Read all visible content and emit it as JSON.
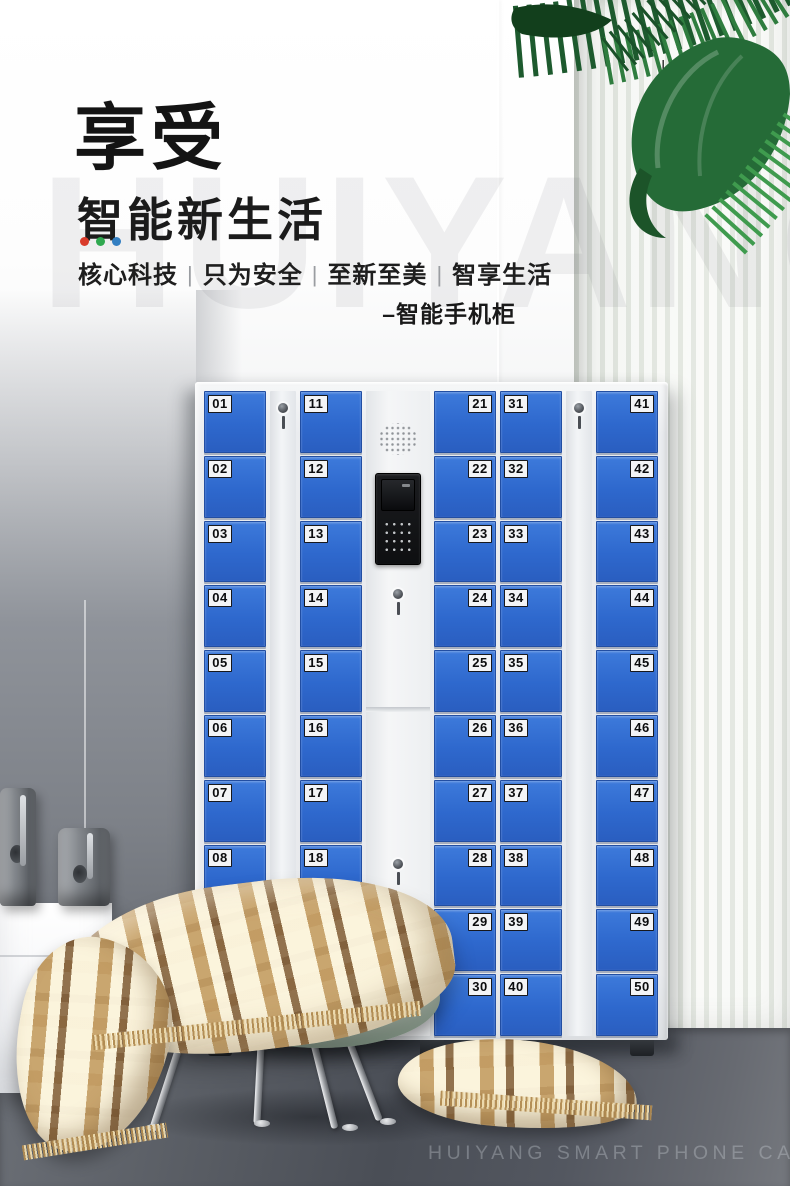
{
  "page": {
    "heading": "享受",
    "subheading": "智能新生活",
    "accent_dot_colors": [
      "#d93b2b",
      "#2fa84f",
      "#337fc2"
    ],
    "tagline_segments": [
      "核心科技",
      "只为安全",
      "至新至美",
      "智享生活"
    ],
    "tagline_separator": "|",
    "product_label": "–智能手机柜",
    "vertical_tag": "–ENJOY",
    "watermark": "HUIYANG",
    "footer_caption": "HUIYANG SMART PHONE CABINET"
  },
  "cabinet": {
    "door_color": "#2e68cd",
    "body_color": "#eaecef",
    "columns": [
      {
        "type": "doors",
        "name": "locker-column-1",
        "label_side": "left",
        "numbers": [
          "01",
          "02",
          "03",
          "04",
          "05",
          "06",
          "07",
          "08",
          "09",
          "10"
        ]
      },
      {
        "type": "lock",
        "name": "lock-strip-1"
      },
      {
        "type": "doors",
        "name": "locker-column-2",
        "label_side": "left",
        "numbers": [
          "11",
          "12",
          "13",
          "14",
          "15",
          "16",
          "17",
          "18",
          "19",
          "20"
        ]
      },
      {
        "type": "panel",
        "name": "control-column"
      },
      {
        "type": "doors",
        "name": "locker-column-3",
        "label_side": "right",
        "numbers": [
          "21",
          "22",
          "23",
          "24",
          "25",
          "26",
          "27",
          "28",
          "29",
          "30"
        ]
      },
      {
        "type": "doors",
        "name": "locker-column-4",
        "label_side": "left",
        "numbers": [
          "31",
          "32",
          "33",
          "34",
          "35",
          "36",
          "37",
          "38",
          "39",
          "40"
        ]
      },
      {
        "type": "lock",
        "name": "lock-strip-2"
      },
      {
        "type": "doors",
        "name": "locker-column-5",
        "label_side": "right",
        "numbers": [
          "41",
          "42",
          "43",
          "44",
          "45",
          "46",
          "47",
          "48",
          "49",
          "50"
        ]
      }
    ]
  }
}
